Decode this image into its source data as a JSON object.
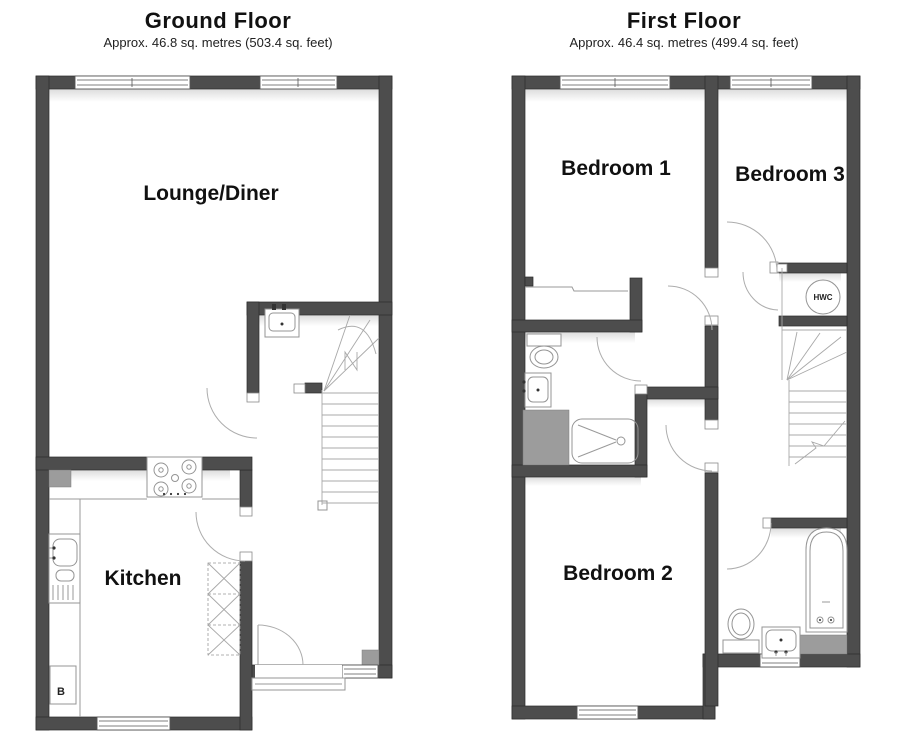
{
  "ground_floor": {
    "title": "Ground Floor",
    "subtitle": "Approx. 46.8 sq. metres (503.4 sq. feet)",
    "rooms": {
      "lounge_diner": "Lounge/Diner",
      "kitchen": "Kitchen"
    },
    "fixtures": {
      "boiler": "B"
    }
  },
  "first_floor": {
    "title": "First Floor",
    "subtitle": "Approx. 46.4 sq. metres (499.4 sq. feet)",
    "rooms": {
      "bedroom1": "Bedroom 1",
      "bedroom2": "Bedroom 2",
      "bedroom3": "Bedroom 3"
    },
    "fixtures": {
      "hot_water_cylinder": "HWC"
    }
  },
  "colors": {
    "wall": "#4d4d4d",
    "fixture_line": "#949494",
    "gray_block": "#9c9c9c",
    "background": "#ffffff",
    "text": "#111111"
  }
}
